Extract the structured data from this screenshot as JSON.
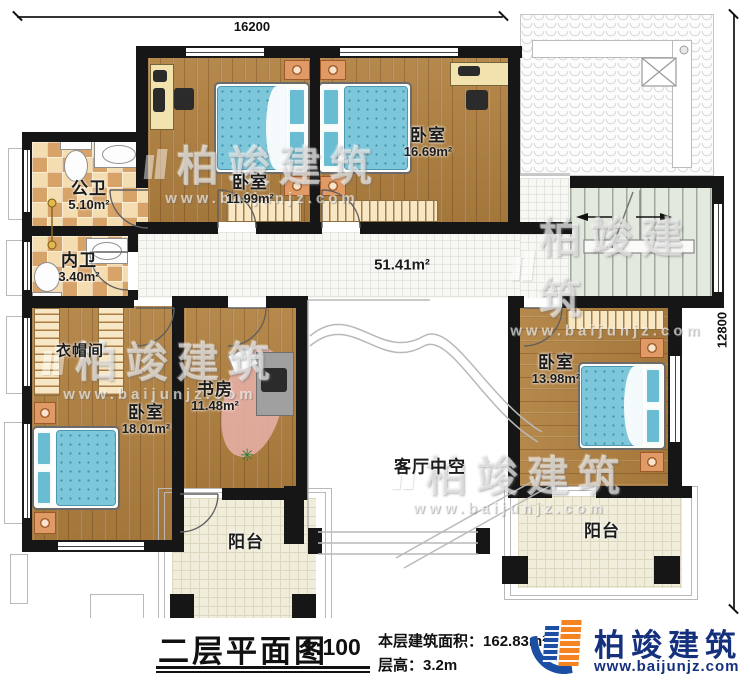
{
  "dimensions": {
    "top": "16200",
    "right": "12800"
  },
  "rooms": {
    "gongwei": {
      "name": "公卫",
      "area": "5.10m²"
    },
    "neiwei": {
      "name": "内卫",
      "area": "3.40m²"
    },
    "bed1": {
      "name": "卧室",
      "area": "11.99m²"
    },
    "bed2": {
      "name": "卧室",
      "area": "16.69m²"
    },
    "hall": {
      "area": "51.41m²"
    },
    "cloak": {
      "name": "衣帽间"
    },
    "bed3": {
      "name": "卧室",
      "area": "18.01m²"
    },
    "study": {
      "name": "书房",
      "area": "11.48m²"
    },
    "bed4": {
      "name": "卧室",
      "area": "13.98m²"
    },
    "void": {
      "name": "客厅中空"
    },
    "balcony_left": {
      "name": "阳台"
    },
    "balcony_right": {
      "name": "阳台"
    }
  },
  "footer": {
    "title": "二层平面图",
    "scale": "1:100",
    "area_label": "本层建筑面积：",
    "area_value": "162.83m²",
    "height_label": "层高：",
    "height_value": "3.2m"
  },
  "brand": {
    "name": "柏竣建筑",
    "site": "www.baijunjz.com"
  },
  "icons": {
    "plant": "✳"
  }
}
